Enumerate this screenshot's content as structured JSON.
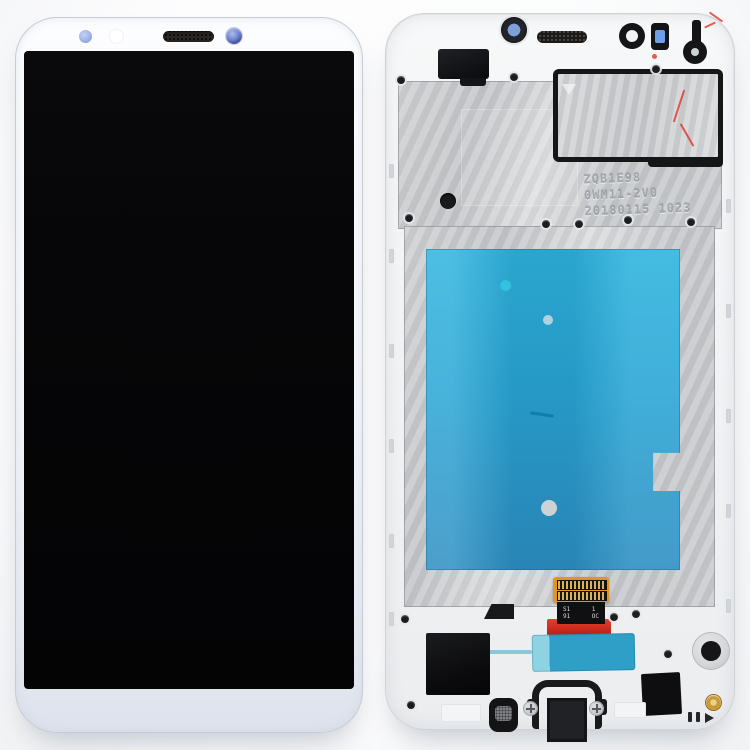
{
  "stamp": {
    "line1": "ZQB1E98",
    "line2": "0WM11-2V0",
    "line3": "20180115 1023"
  },
  "flex_marking": {
    "tl": "S1",
    "bl": "91",
    "tr": "1",
    "br": "OC"
  },
  "front_view": {
    "parts": [
      "bezel",
      "proximity-sensor",
      "notification-led",
      "earpiece-speaker",
      "front-camera",
      "lcd-screen"
    ]
  },
  "back_view": {
    "parts": [
      "mid-frame",
      "rear-camera-lens",
      "earpiece-mesh-slot",
      "camera-ring-hole",
      "sensor-window",
      "headphone-jack-bracket",
      "front-camera-module",
      "emi-shield-plate",
      "rubber-gasket",
      "serial-stamp",
      "lcd-back-plate",
      "blue-protective-film",
      "lcd-flex-cable",
      "flex-connector",
      "adhesive-tab",
      "loudspeaker-mesh",
      "charging-port-bracket",
      "vibration-motor",
      "gold-screw",
      "screws"
    ]
  },
  "colors": {
    "bg": "#fafbfc",
    "bezel_top": "#fcfdfe",
    "bezel_bot": "#dde2ec",
    "bezel_border": "#c7cbd3",
    "screen": "#060608",
    "frame": "#f1f2f4",
    "frame_border": "#cfd2d6",
    "metal": "#c7c9cc",
    "metal_light": "#dadcde",
    "gasket": "#161617",
    "sticker": "#2fb4de",
    "sticker_deep": "#2e8fc2",
    "tab": "#2f9fc8",
    "tab_light": "#8ed3e2",
    "flex_orange": "#e2941c",
    "flex_pin": "#d9b25a",
    "flex_black": "#101012",
    "flex_red": "#cb2c1e",
    "sensor_blue": "#9db2e6",
    "cam_blue": "#31408f",
    "window_blue": "#6f9fe8",
    "gold": "#c89a3a",
    "gold_light": "#ead28a",
    "red": "#e03525",
    "motor_ring": "#d5d6d8"
  }
}
